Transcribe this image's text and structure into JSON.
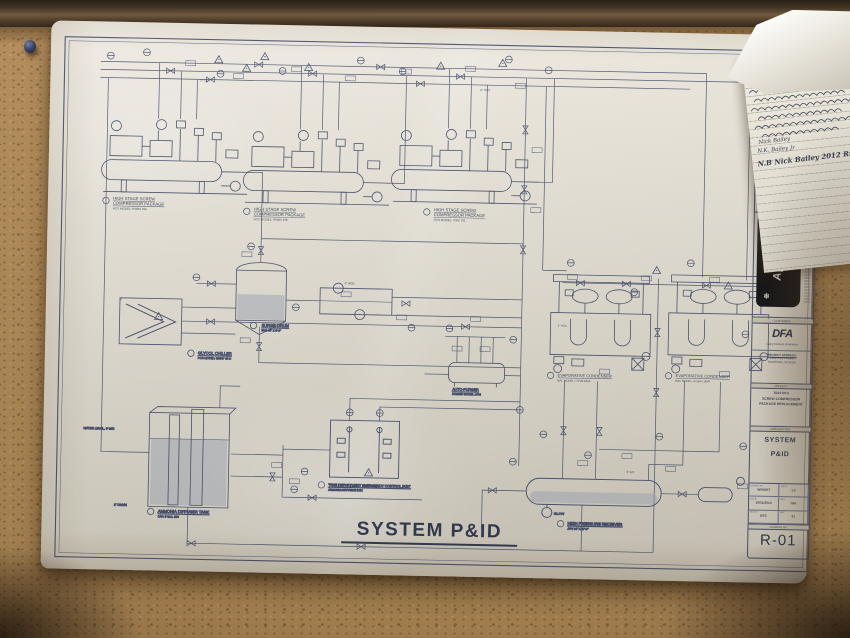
{
  "drawing": {
    "main_title": "SYSTEM P&ID",
    "pipe_labels": [
      "4\" HGD",
      "2\" HSS",
      "3\" CD",
      "1\" HGL",
      "6\" ES"
    ],
    "equipment": {
      "comp_pkg_1": {
        "line1": "HIGH STAGE SCREW",
        "line2": "COMPRESSOR PACKAGE",
        "line3": "RCS MODEL: RWBII 496"
      },
      "comp_pkg_2": {
        "line1": "HIGH STAGE SCREW",
        "line2": "COMPRESSOR PACKAGE",
        "line3": "RCS MODEL: RWBII 496"
      },
      "comp_pkg_3": {
        "line1": "HIGH STAGE SCREW",
        "line2": "COMPRESSOR PACKAGE",
        "line3": "RCS MODEL: VSM 701"
      },
      "surge_drum": {
        "line1": "SURGE DRUM",
        "line2": "RVS 48\" X 9'-6\""
      },
      "glycol_chiller": {
        "line1": "GLYCOL CHILLER",
        "line2": "PCS MODEL: GWHP 60 S"
      },
      "auto_purger": {
        "line1": "AUTO-PURGER",
        "line2": "HANSEN MODEL: APM"
      },
      "evap_cond_1": {
        "line1": "EVAPORATIVE CONDENSER",
        "line2": "BAC MODEL: CXVB-185A"
      },
      "evap_cond_2": {
        "line1": "EVAPORATIVE CONDENSER",
        "line2": "BAC MODEL: ECBAT-185R"
      },
      "ammonia_tank": {
        "line1": "AMMONIA DIFFUSER TANK",
        "line2": "CAP: 5 W.C. 500"
      },
      "fire_box": {
        "line1": "\"FIRE DEPARTMENT EMERGENCY CONTROL BOX\"",
        "line2": "AMMONIA DIFFUSION BOX"
      },
      "hp_receiver": {
        "line1": "HIGH PRESSURE RECEIVER",
        "line2": "APV 84\" X 17'-0\""
      },
      "oil_pot": "OIL POT",
      "water_level": "WATER LEVEL, 6' MIN",
      "drain": "1\" DRAIN"
    }
  },
  "title_block": {
    "revisions_header": "REVISIONS",
    "apcco_name": "Apcco",
    "snowflake": "❄",
    "customer_label": "CUSTOMER:",
    "dfa_name": "DFA",
    "dfa_subtitle": "Dairy Farmers of America",
    "project_address_label": "PROJECT ADDRESS:",
    "address_line1": "2314 TULLY ROAD",
    "address_line2": "HUGHSON, CA 95326",
    "project_label": "PROJECT:",
    "project_line1": "2014 RC3",
    "project_line2": "SCREW COMPRESSOR",
    "project_line3": "PACKAGE REPLACEMENT",
    "description_label": "DESCRIPTION:",
    "description_line1": "SYSTEM",
    "description_line2": "P&ID",
    "fields": [
      {
        "label": "DRAWN BY:",
        "value": "WRIGHT",
        "label2": "APPD:",
        "value2": "LC"
      },
      {
        "label": "DATE:",
        "value": "10/31/2014",
        "label2": "REV:",
        "value2": "BH"
      },
      {
        "label": "SCALE:",
        "value": "NTS",
        "label2": "SHT:",
        "value2": "01"
      }
    ],
    "drawing_no_label": "DRAWING NO:",
    "drawing_no": "R-01"
  },
  "note": {
    "entries": [
      "Nick Bailey",
      "N.K. Bailey  Jr",
      "N.B  Nick Bailey  2012  Rm"
    ]
  },
  "colors": {
    "ink": "#46536e",
    "paper": "#e8e4da",
    "cork": "#b18a57",
    "apcco_band": "#17171b"
  }
}
